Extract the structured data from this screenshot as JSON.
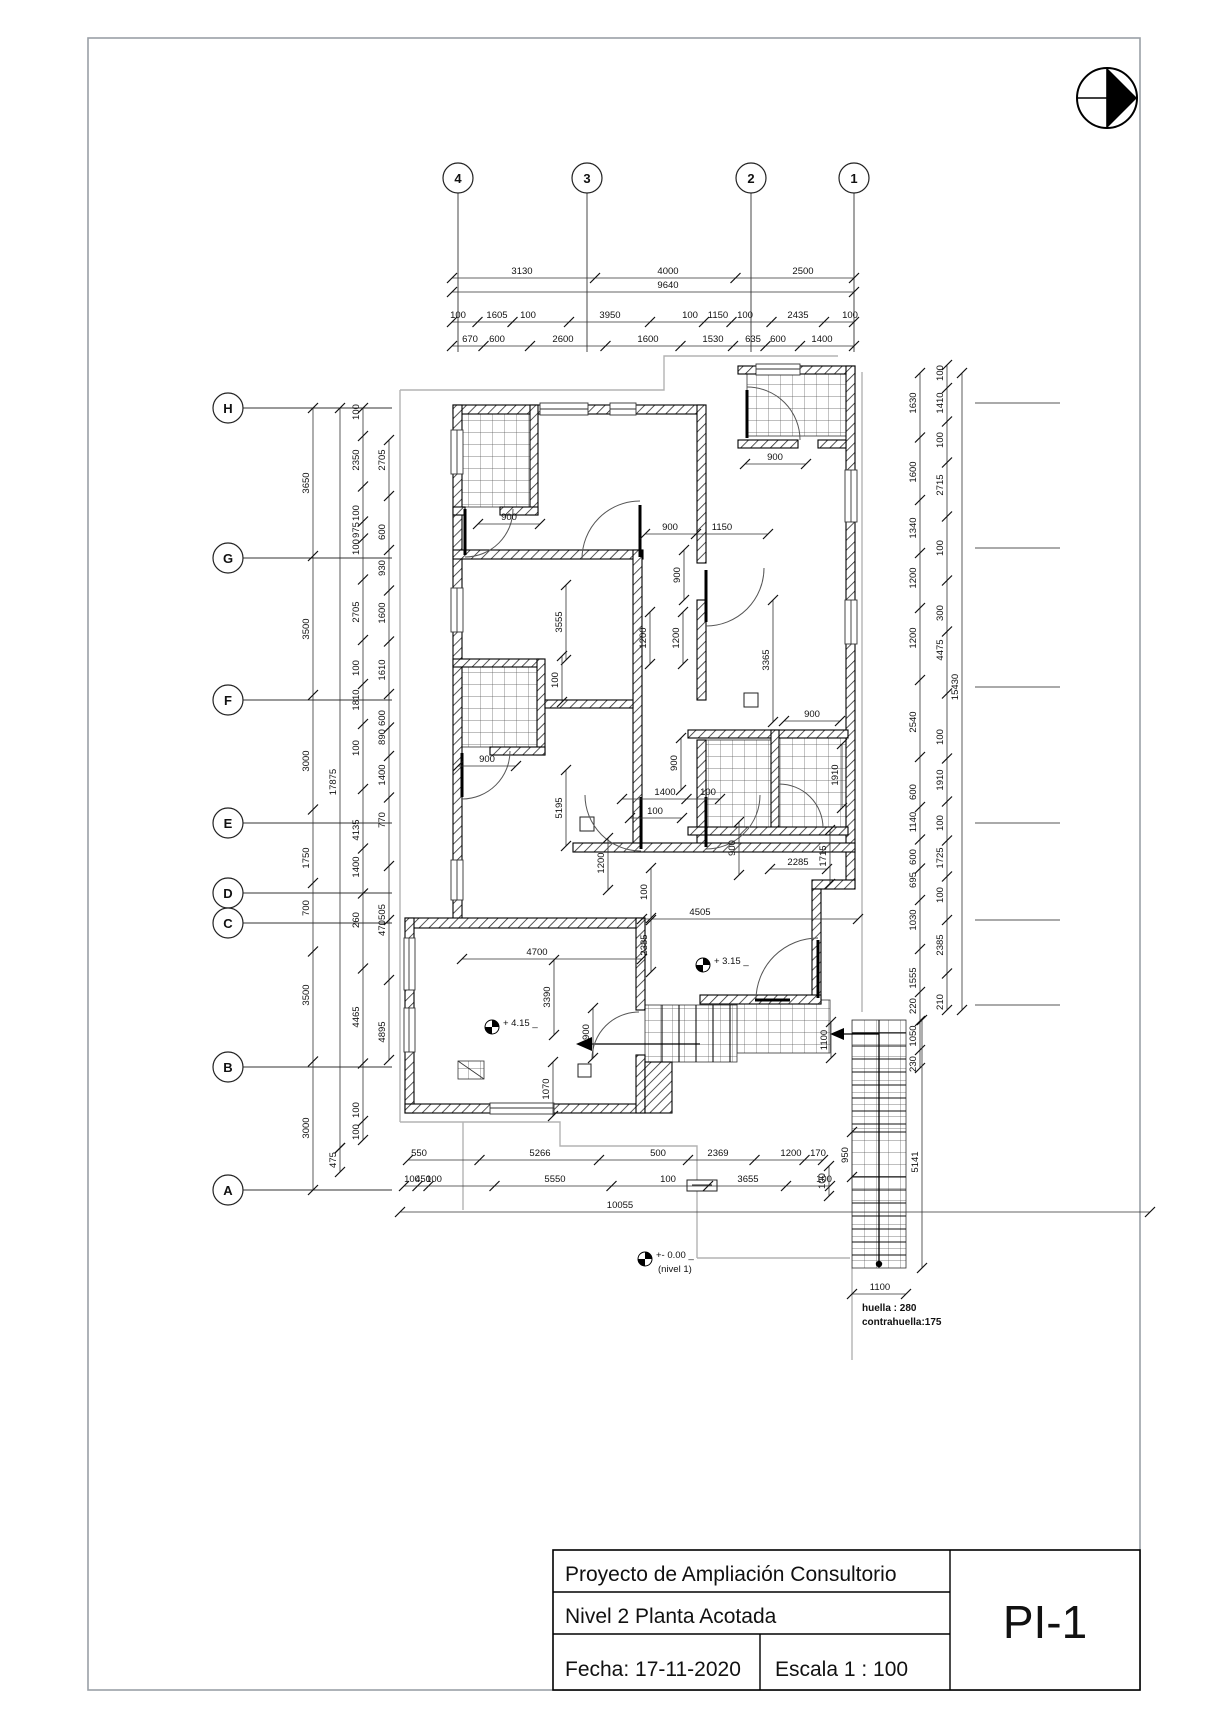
{
  "sheet": {
    "title": "Proyecto de Ampliación Consultorio",
    "subtitle": "Nivel 2  Planta Acotada",
    "date": "Fecha: 17-11-2020",
    "scale": "Escala  1 : 100",
    "code": "PI-1"
  },
  "notes": {
    "huella": "huella : 280",
    "contrahuella": "contrahuella:175",
    "level_plus_415": "+ 4.15",
    "level_plus_315": "+ 3.15",
    "level_zero": "+- 0.00",
    "level_zero_sub": "(nivel 1)"
  },
  "grid": {
    "top": [
      {
        "label": "4",
        "x": 458
      },
      {
        "label": "3",
        "x": 587
      },
      {
        "label": "2",
        "x": 751
      },
      {
        "label": "1",
        "x": 854
      }
    ],
    "left": [
      {
        "label": "H",
        "y": 408
      },
      {
        "label": "G",
        "y": 558
      },
      {
        "label": "F",
        "y": 700
      },
      {
        "label": "E",
        "y": 823
      },
      {
        "label": "D",
        "y": 893
      },
      {
        "label": "C",
        "y": 923
      },
      {
        "label": "B",
        "y": 1067
      },
      {
        "label": "A",
        "y": 1190
      }
    ]
  },
  "levels": [
    {
      "text": "+ 4.15",
      "mx": 492,
      "my": 1027
    },
    {
      "text": "+ 3.15",
      "mx": 703,
      "my": 965
    },
    {
      "text": "+- 0.00",
      "mx": 645,
      "my": 1259,
      "sub": "(nivel 1)"
    }
  ],
  "chains": [
    {
      "dir": "h",
      "c": 278,
      "from": 452,
      "to": 854,
      "labels": [
        [
          "3130",
          522
        ],
        [
          "4000",
          668
        ],
        [
          "2500",
          803
        ]
      ]
    },
    {
      "dir": "h",
      "c": 292,
      "from": 452,
      "to": 854,
      "labels": [
        [
          "9640",
          668
        ]
      ]
    },
    {
      "dir": "h",
      "c": 322,
      "from": 452,
      "to": 854,
      "labels": [
        [
          "100",
          458
        ],
        [
          "1605",
          497
        ],
        [
          "100",
          528
        ],
        [
          "3950",
          610
        ],
        [
          "100",
          690
        ],
        [
          "1150",
          718
        ],
        [
          "100",
          745
        ],
        [
          "2435",
          798
        ],
        [
          "100",
          850
        ]
      ]
    },
    {
      "dir": "h",
      "c": 346,
      "from": 452,
      "to": 854,
      "labels": [
        [
          "670",
          470
        ],
        [
          "600",
          497
        ],
        [
          "2600",
          563
        ],
        [
          "1600",
          648
        ],
        [
          "1530",
          713
        ],
        [
          "635",
          753
        ],
        [
          "600",
          778
        ],
        [
          "1400",
          822
        ]
      ]
    },
    {
      "dir": "v",
      "c": 313,
      "from": 408,
      "to": 1190,
      "labels": [
        [
          "3650",
          483
        ],
        [
          "3500",
          629
        ],
        [
          "3000",
          761
        ],
        [
          "1750",
          858
        ],
        [
          "700",
          908
        ],
        [
          "3500",
          995
        ],
        [
          "3000",
          1128
        ]
      ]
    },
    {
      "dir": "v",
      "c": 340,
      "from": 408,
      "to": 1148,
      "labels": [
        [
          "17875",
          782
        ]
      ]
    },
    {
      "dir": "v",
      "c": 340,
      "from": 1148,
      "to": 1172,
      "labels": [
        [
          "475",
          1160
        ]
      ]
    },
    {
      "dir": "v",
      "c": 363,
      "from": 408,
      "to": 1140,
      "labels": [
        [
          "100",
          412
        ],
        [
          "2350",
          460
        ],
        [
          "100",
          513
        ],
        [
          "975",
          530
        ],
        [
          "100",
          547
        ],
        [
          "2705",
          612
        ],
        [
          "100",
          668
        ],
        [
          "1810",
          700
        ],
        [
          "100",
          748
        ],
        [
          "4135",
          830
        ],
        [
          "1400",
          867
        ],
        [
          "260",
          920
        ],
        [
          "4465",
          1017
        ],
        [
          "100",
          1110
        ],
        [
          "100",
          1132
        ]
      ]
    },
    {
      "dir": "v",
      "c": 389,
      "from": 440,
      "to": 1060,
      "labels": [
        [
          "2705",
          460
        ],
        [
          "600",
          532
        ],
        [
          "930",
          568
        ],
        [
          "1600",
          613
        ],
        [
          "1610",
          670
        ],
        [
          "600",
          718
        ],
        [
          "890",
          737
        ],
        [
          "1400",
          775
        ],
        [
          "770",
          820
        ],
        [
          "505",
          912
        ],
        [
          "470",
          928
        ],
        [
          "4895",
          1032
        ]
      ]
    },
    {
      "dir": "v",
      "c": 920,
      "from": 373,
      "to": 1068,
      "labels": [
        [
          "1630",
          403
        ],
        [
          "1600",
          472
        ],
        [
          "1340",
          528
        ],
        [
          "1200",
          578
        ],
        [
          "1200",
          638
        ],
        [
          "2540",
          722
        ],
        [
          "600",
          792
        ],
        [
          "1140",
          822
        ],
        [
          "600",
          857
        ],
        [
          "695",
          880
        ],
        [
          "1030",
          920
        ],
        [
          "1555",
          978
        ],
        [
          "220",
          1006
        ],
        [
          "1050",
          1036
        ],
        [
          "230",
          1064
        ]
      ]
    },
    {
      "dir": "v",
      "c": 947,
      "from": 365,
      "to": 1010,
      "labels": [
        [
          "100",
          373
        ],
        [
          "1410",
          403
        ],
        [
          "100",
          440
        ],
        [
          "2715",
          485
        ],
        [
          "100",
          548
        ],
        [
          "300",
          613
        ],
        [
          "4475",
          650
        ],
        [
          "100",
          737
        ],
        [
          "1910",
          780
        ],
        [
          "100",
          823
        ],
        [
          "1725",
          858
        ],
        [
          "100",
          895
        ],
        [
          "2385",
          945
        ],
        [
          "210",
          1002
        ]
      ]
    },
    {
      "dir": "v",
      "c": 962,
      "from": 373,
      "to": 1010,
      "labels": [
        [
          "15430",
          687
        ]
      ]
    },
    {
      "dir": "h",
      "c": 1160,
      "from": 408,
      "to": 823,
      "labels": [
        [
          "550",
          419
        ],
        [
          "5266",
          540
        ],
        [
          "500",
          658
        ],
        [
          "2369",
          718
        ],
        [
          "1200",
          791
        ],
        [
          "170",
          818
        ]
      ]
    },
    {
      "dir": "h",
      "c": 1186,
      "from": 404,
      "to": 830,
      "labels": [
        [
          "100",
          412
        ],
        [
          "450",
          423
        ],
        [
          "100",
          434
        ],
        [
          "5550",
          555
        ],
        [
          "100",
          668
        ],
        [
          "3655",
          748
        ],
        [
          "100",
          824
        ]
      ]
    },
    {
      "dir": "h",
      "c": 1212,
      "from": 400,
      "to": 1150,
      "labels": [
        [
          "10055",
          620
        ]
      ]
    },
    {
      "dir": "v",
      "c": 852,
      "from": 1132,
      "to": 1177,
      "labels": [
        [
          "950",
          1155
        ]
      ]
    },
    {
      "dir": "v",
      "c": 922,
      "from": 1020,
      "to": 1268,
      "labels": [
        [
          "5141",
          1162
        ]
      ]
    },
    {
      "dir": "v",
      "c": 831,
      "from": 1022,
      "to": 1058,
      "labels": [
        [
          "1100",
          1040
        ]
      ]
    },
    {
      "dir": "h",
      "c": 1294,
      "from": 852,
      "to": 906,
      "labels": [
        [
          "1100",
          880
        ]
      ]
    },
    {
      "dir": "v",
      "c": 829,
      "from": 1166,
      "to": 1196,
      "labels": [
        [
          "100",
          1181
        ]
      ]
    },
    {
      "dir": "h",
      "c": 524,
      "from": 478,
      "to": 540,
      "labels": [
        [
          "900",
          509
        ]
      ]
    },
    {
      "dir": "h",
      "c": 464,
      "from": 745,
      "to": 806,
      "labels": [
        [
          "900",
          775
        ]
      ]
    },
    {
      "dir": "h",
      "c": 534,
      "from": 645,
      "to": 768,
      "labels": [
        [
          "900",
          670
        ],
        [
          "1150",
          722
        ]
      ]
    },
    {
      "dir": "v",
      "c": 684,
      "from": 550,
      "to": 600,
      "labels": [
        [
          "900",
          575
        ]
      ]
    },
    {
      "dir": "v",
      "c": 566,
      "from": 585,
      "to": 660,
      "labels": [
        [
          "3555",
          622
        ]
      ]
    },
    {
      "dir": "v",
      "c": 650,
      "from": 612,
      "to": 664,
      "labels": [
        [
          "1200",
          638
        ]
      ]
    },
    {
      "dir": "v",
      "c": 683,
      "from": 612,
      "to": 664,
      "labels": [
        [
          "1200",
          638
        ]
      ]
    },
    {
      "dir": "v",
      "c": 773,
      "from": 600,
      "to": 722,
      "labels": [
        [
          "3365",
          660
        ]
      ]
    },
    {
      "dir": "v",
      "c": 562,
      "from": 656,
      "to": 702,
      "labels": [
        [
          "100",
          680
        ]
      ]
    },
    {
      "dir": "h",
      "c": 766,
      "from": 458,
      "to": 516,
      "labels": [
        [
          "900",
          487
        ]
      ]
    },
    {
      "dir": "v",
      "c": 681,
      "from": 738,
      "to": 790,
      "labels": [
        [
          "900",
          763
        ]
      ]
    },
    {
      "dir": "h",
      "c": 799,
      "from": 622,
      "to": 720,
      "labels": [
        [
          "1400",
          665
        ],
        [
          "100",
          708
        ]
      ]
    },
    {
      "dir": "h",
      "c": 818,
      "from": 630,
      "to": 682,
      "labels": [
        [
          "100",
          655
        ]
      ]
    },
    {
      "dir": "v",
      "c": 566,
      "from": 770,
      "to": 846,
      "labels": [
        [
          "5195",
          808
        ]
      ]
    },
    {
      "dir": "h",
      "c": 721,
      "from": 784,
      "to": 840,
      "labels": [
        [
          "900",
          812
        ]
      ]
    },
    {
      "dir": "v",
      "c": 842,
      "from": 744,
      "to": 808,
      "labels": [
        [
          "1910",
          775
        ]
      ]
    },
    {
      "dir": "h",
      "c": 869,
      "from": 770,
      "to": 827,
      "labels": [
        [
          "2285",
          798
        ]
      ]
    },
    {
      "dir": "v",
      "c": 830,
      "from": 830,
      "to": 884,
      "labels": [
        [
          "1715",
          856
        ]
      ]
    },
    {
      "dir": "v",
      "c": 739,
      "from": 822,
      "to": 875,
      "labels": [
        [
          "900",
          848
        ]
      ]
    },
    {
      "dir": "v",
      "c": 608,
      "from": 838,
      "to": 890,
      "labels": [
        [
          "1200",
          863
        ]
      ]
    },
    {
      "dir": "v",
      "c": 651,
      "from": 868,
      "to": 918,
      "labels": [
        [
          "100",
          892
        ]
      ]
    },
    {
      "dir": "h",
      "c": 919,
      "from": 642,
      "to": 858,
      "labels": [
        [
          "4505",
          700
        ]
      ]
    },
    {
      "dir": "v",
      "c": 651,
      "from": 920,
      "to": 972,
      "labels": [
        [
          "2385",
          945
        ]
      ]
    },
    {
      "dir": "h",
      "c": 959,
      "from": 462,
      "to": 642,
      "labels": [
        [
          "4700",
          537
        ]
      ]
    },
    {
      "dir": "v",
      "c": 554,
      "from": 960,
      "to": 1035,
      "labels": [
        [
          "3390",
          997
        ]
      ]
    },
    {
      "dir": "v",
      "c": 593,
      "from": 1008,
      "to": 1058,
      "labels": [
        [
          "900",
          1032
        ]
      ]
    },
    {
      "dir": "v",
      "c": 553,
      "from": 1062,
      "to": 1116,
      "labels": [
        [
          "1070",
          1089
        ]
      ]
    }
  ]
}
